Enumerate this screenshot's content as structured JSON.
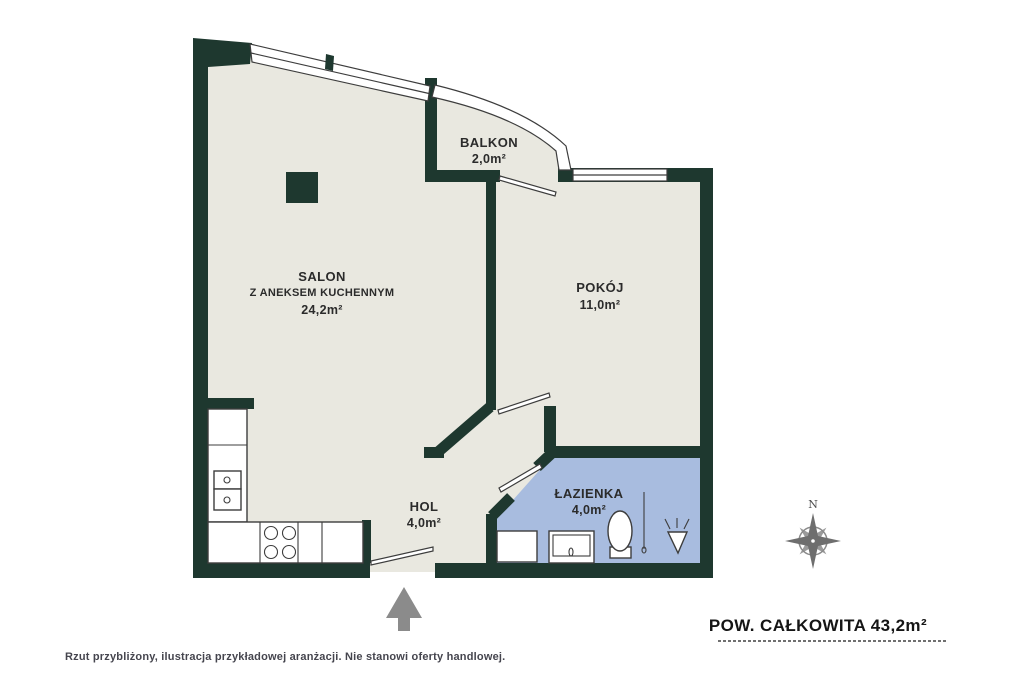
{
  "colors": {
    "wall": "#1e382f",
    "floor": "#e9e8e0",
    "bathroom_floor": "#a8bcdf",
    "outline": "#3d3d3d",
    "accent_gray": "#8b8b8b",
    "text": "#2b2b2b",
    "footer_text": "#45454e"
  },
  "rooms": {
    "salon": {
      "name": "SALON",
      "name2": "Z ANEKSEM KUCHENNYM",
      "area": "24,2m²"
    },
    "balkon": {
      "name": "BALKON",
      "area": "2,0m²"
    },
    "pokoj": {
      "name": "POKÓJ",
      "area": "11,0m²"
    },
    "hol": {
      "name": "HOL",
      "area": "4,0m²"
    },
    "lazienka": {
      "name": "ŁAZIENKA",
      "area": "4,0m²"
    }
  },
  "compass": {
    "north": "N"
  },
  "summary": {
    "total": "POW. CAŁKOWITA 43,2m²"
  },
  "footer": {
    "disclaimer": "Rzut przybliżony, ilustracja przykładowej aranżacji. Nie stanowi oferty handlowej."
  },
  "fixtures": {
    "kitchen": [
      "fridge-cabinet",
      "oven-units",
      "cooktop",
      "countertop"
    ],
    "bathroom": [
      "washing-machine",
      "sink",
      "toilet",
      "towel-radiator",
      "shower-head"
    ]
  },
  "icons": {
    "entrance_arrow": "up-arrow",
    "compass_rose": "compass-rose"
  }
}
